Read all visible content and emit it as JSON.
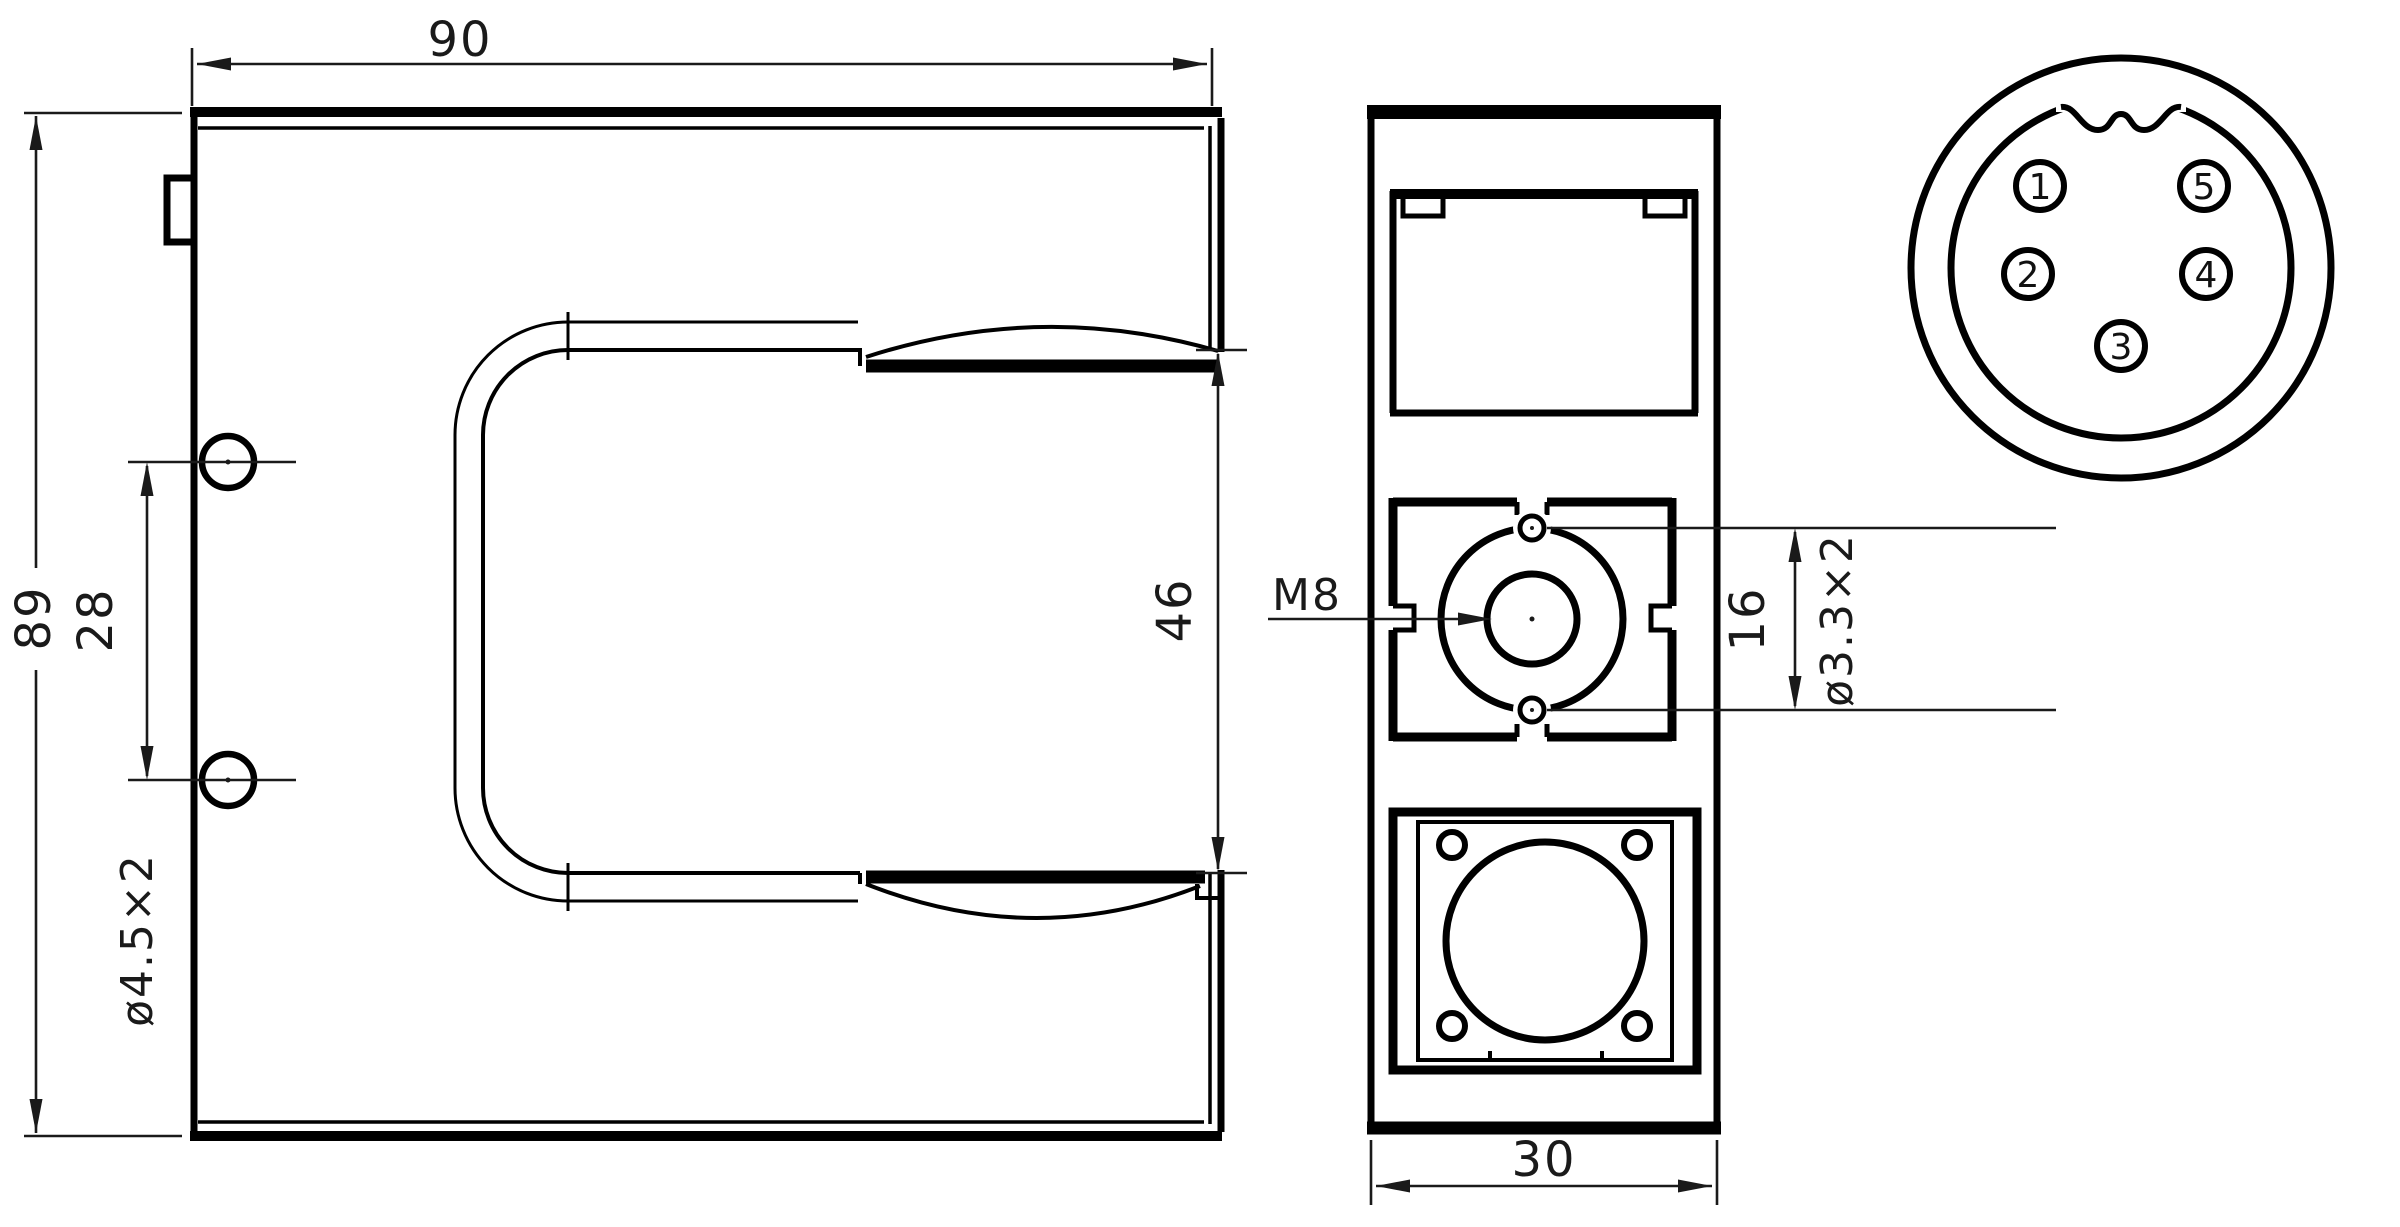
{
  "front_view": {
    "dim_width": "90",
    "dim_height": "89",
    "dim_hole_spacing": "28",
    "dim_hole_size": "ø4.5x2",
    "dim_slot_width": "46"
  },
  "side_view": {
    "thread_label": "M8",
    "dim_hole_spacing": "16",
    "dim_hole_size": "ø3.3x2",
    "dim_depth": "30"
  },
  "connector_view": {
    "pins": [
      "1",
      "2",
      "3",
      "4",
      "5"
    ]
  },
  "colors": {
    "line": "#000000",
    "background": "#ffffff",
    "text": "#1a1a1a"
  }
}
